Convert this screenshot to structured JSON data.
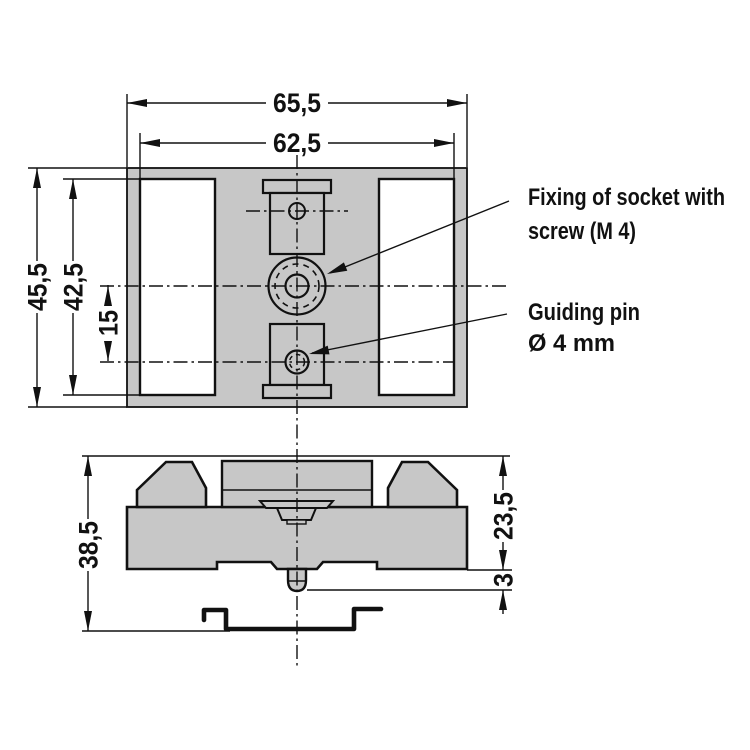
{
  "dimensions": {
    "outer_width": "65,5",
    "inner_width": "62,5",
    "outer_height": "45,5",
    "cutout_height": "42,5",
    "hole_spacing": "15",
    "side_total_height": "38,5",
    "side_upper_height": "23,5",
    "pin_protrusion": "3"
  },
  "labels": {
    "fixing_line1": "Fixing of socket with",
    "fixing_line2": "screw (M 4)",
    "guiding_line1": "Guiding pin",
    "guiding_line2": "Ø 4 mm"
  },
  "colors": {
    "part_fill": "#c7c7c7",
    "line": "#111111",
    "background": "#ffffff"
  }
}
